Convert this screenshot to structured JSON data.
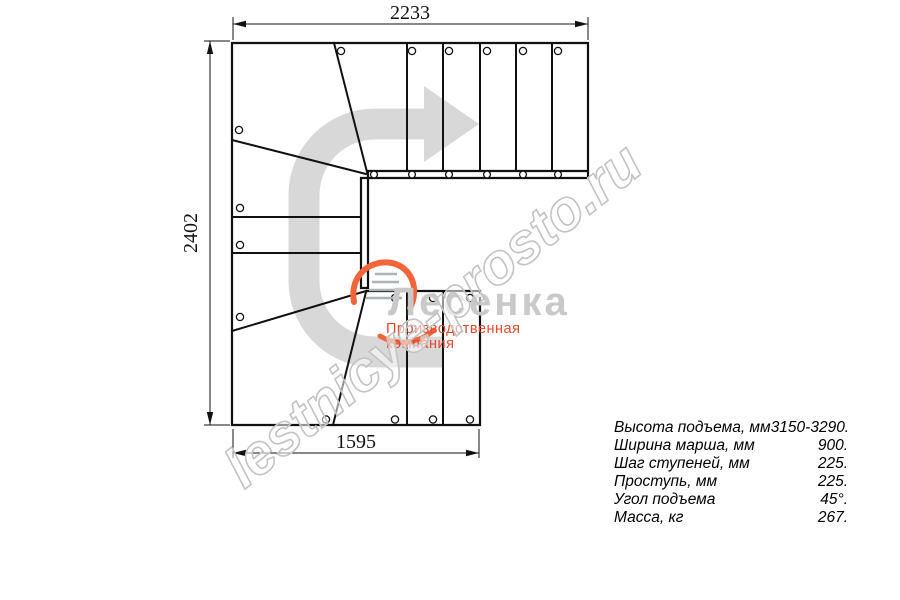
{
  "drawing": {
    "type": "stair-plan-top-view",
    "dimensions": {
      "top": "2233",
      "left": "2402",
      "bottom": "1595"
    },
    "direction_arrow": "u-turn-travel-arrow"
  },
  "specs": {
    "rows": [
      {
        "label": "Высота подъема, мм",
        "value": "3150-3290."
      },
      {
        "label": "Ширина марша, мм",
        "value": "900."
      },
      {
        "label": "Шаг ступеней, мм",
        "value": "225."
      },
      {
        "label": "Проступь, мм",
        "value": "225."
      },
      {
        "label": "Угол подъема",
        "value": "45°."
      },
      {
        "label": "Масса, кг",
        "value": "267."
      }
    ]
  },
  "watermark": {
    "text": "lestnicye-prosto.ru"
  },
  "logo": {
    "name": "Лесенка",
    "tagline": "Производственная компания"
  },
  "colors": {
    "line": "#111111",
    "arrow_gray": "#d8d8d8",
    "watermark_gray": "#c3c3c3",
    "logo_name_gray": "#c9c9c9",
    "logo_accent_orange": "#f0663a",
    "logo_tagline_red": "#e8472b"
  }
}
